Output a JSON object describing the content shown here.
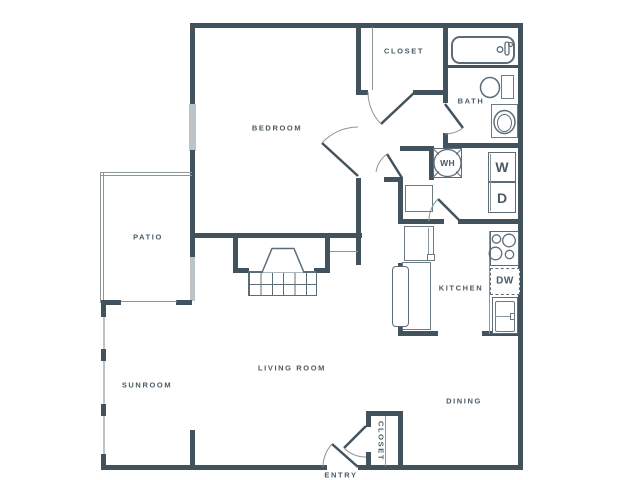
{
  "meta": {
    "type": "apartment-floor-plan",
    "canvas": {
      "width": 640,
      "height": 480
    }
  },
  "colors": {
    "background": "#ffffff",
    "wall": "#43535e",
    "fixture_line": "#5d6d77",
    "window": "#bdc4c8",
    "label_text": "#4a5a63"
  },
  "rooms": {
    "bedroom": "BEDROOM",
    "bedroom_closet": "CLOSET",
    "bath": "BATH",
    "kitchen": "KITCHEN",
    "dining": "DINING",
    "living_room": "LIVING ROOM",
    "sunroom": "SUNROOM",
    "patio": "PATIO",
    "entry": "ENTRY",
    "entry_closet": "CLOSET"
  },
  "appliances": {
    "washer": "W",
    "dryer": "D",
    "water_heater": "WH",
    "dishwasher": "DW"
  }
}
